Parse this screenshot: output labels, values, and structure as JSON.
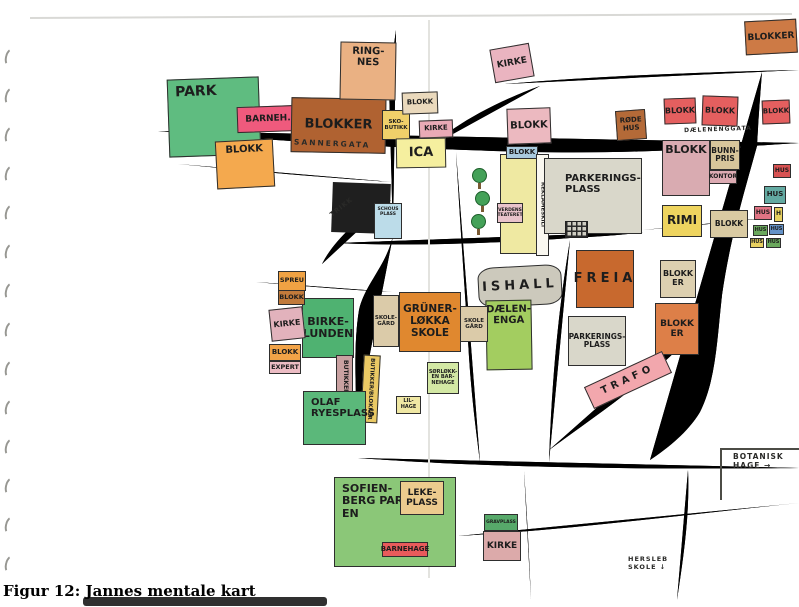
{
  "page": {
    "caption": "Figur 12: Jannes mentale kart"
  },
  "map": {
    "colors": {
      "road_fill": "#b9bdb2",
      "road_outline": "#57564e",
      "park_green": "#5fbc80",
      "crayon_orange": "#e0882f",
      "crayon_red": "#e45f5f",
      "paper": "#ffffff"
    },
    "street_labels": [
      {
        "id": "sannergata",
        "text": "SANNERGATA",
        "x": 294,
        "y": 139,
        "rot": 2.5,
        "fz": 7.5,
        "ls": 2
      },
      {
        "id": "dalenenggata",
        "text": "DÆLENENGGATA",
        "x": 684,
        "y": 126,
        "rot": -2,
        "fz": 6,
        "ls": 1
      },
      {
        "id": "trikk",
        "text": "TRIKK",
        "x": 328,
        "y": 203,
        "rot": -38,
        "fz": 6.5,
        "ls": 1
      },
      {
        "id": "botanisk-hage",
        "text": "BOTANISK\nHAGE →",
        "x": 733,
        "y": 452,
        "rot": 0,
        "fz": 7.5,
        "ls": 1
      },
      {
        "id": "hersleb-skole",
        "text": "HERSLEB\nSKOLE ↓",
        "x": 628,
        "y": 555,
        "rot": 0,
        "fz": 6.5,
        "ls": 1
      }
    ],
    "blocks": [
      {
        "id": "black-building",
        "label": "",
        "x": 332,
        "y": 183,
        "w": 58,
        "h": 50,
        "bg": "#1f1f1f",
        "rot": 2,
        "fz": 8,
        "cls": "noborder"
      },
      {
        "id": "schous-plass",
        "label": "SCHOUS PLASS",
        "x": 374,
        "y": 203,
        "w": 28,
        "h": 36,
        "bg": "#bcdce9",
        "fz": 4.5,
        "cls": "tt"
      },
      {
        "id": "park",
        "label": "PARK",
        "x": 168,
        "y": 78,
        "w": 92,
        "h": 78,
        "bg": "#5fbc80",
        "rot": -2,
        "fz": 14,
        "cls": "tl"
      },
      {
        "id": "barnehage-nw",
        "label": "BARNEH.",
        "x": 237,
        "y": 106,
        "w": 62,
        "h": 26,
        "bg": "#ef5a7d",
        "rot": -2,
        "fz": 9
      },
      {
        "id": "blokker-nw",
        "label": "BLOKKER",
        "x": 291,
        "y": 98,
        "w": 95,
        "h": 55,
        "bg": "#b06231",
        "rot": 1,
        "fz": 13
      },
      {
        "id": "ringnes",
        "label": "RING-\nNES",
        "x": 340,
        "y": 42,
        "w": 56,
        "h": 58,
        "bg": "#eab183",
        "rot": 1,
        "fz": 10,
        "cls": "tt"
      },
      {
        "id": "blokk-w",
        "label": "BLOKK",
        "x": 216,
        "y": 140,
        "w": 58,
        "h": 48,
        "bg": "#f4a94e",
        "rot": -3,
        "fz": 10,
        "cls": "tt"
      },
      {
        "id": "sko-butikk",
        "label": "SKO-\nBUTIKK",
        "x": 382,
        "y": 110,
        "w": 28,
        "h": 30,
        "bg": "#f0d06a",
        "fz": 5.5
      },
      {
        "id": "blokk-tan-n",
        "label": "BLOKK",
        "x": 402,
        "y": 92,
        "w": 36,
        "h": 22,
        "bg": "#ead9bc",
        "rot": -2,
        "fz": 7
      },
      {
        "id": "kirke-n1",
        "label": "KIRKE",
        "x": 419,
        "y": 120,
        "w": 34,
        "h": 18,
        "bg": "#e9aab6",
        "rot": -2,
        "fz": 7
      },
      {
        "id": "ica",
        "label": "ICA",
        "x": 396,
        "y": 138,
        "w": 50,
        "h": 30,
        "bg": "#f5ef9f",
        "rot": -1,
        "fz": 13
      },
      {
        "id": "kirke-n2",
        "label": "KIRKE",
        "x": 492,
        "y": 46,
        "w": 40,
        "h": 34,
        "bg": "#eab4c0",
        "rot": -10,
        "fz": 9
      },
      {
        "id": "blokk-pink-n",
        "label": "BLOKK",
        "x": 507,
        "y": 108,
        "w": 44,
        "h": 36,
        "bg": "#ecb9c0",
        "rot": -2,
        "fz": 10
      },
      {
        "id": "reklame-building",
        "label": "",
        "x": 500,
        "y": 154,
        "w": 40,
        "h": 100,
        "bg": "#efe9a2",
        "fz": 6
      },
      {
        "id": "blokk-blue-header",
        "label": "BLOKK",
        "x": 506,
        "y": 146,
        "w": 32,
        "h": 13,
        "bg": "#a9cade",
        "fz": 7
      },
      {
        "id": "reklameskilt",
        "label": "REKLAMESKILT",
        "x": 536,
        "y": 154,
        "w": 13,
        "h": 102,
        "bg": "#faf8f0",
        "fz": 5.5,
        "cls": "vert"
      },
      {
        "id": "verdens-teateret",
        "label": "VERDENS\nTEATERET",
        "x": 497,
        "y": 203,
        "w": 26,
        "h": 20,
        "bg": "#e9c3cb",
        "fz": 4.5
      },
      {
        "id": "parkeringsplass-n",
        "label": "PARKERINGS-\nPLASS",
        "x": 544,
        "y": 158,
        "w": 98,
        "h": 76,
        "bg": "#d9d7ca",
        "fz": 10,
        "cls": "pp"
      },
      {
        "id": "rode-hus",
        "label": "RØDE\nHUS",
        "x": 616,
        "y": 110,
        "w": 30,
        "h": 30,
        "bg": "#b46a38",
        "rot": -4,
        "fz": 7
      },
      {
        "id": "blokker-ne",
        "label": "BLOKKER",
        "x": 745,
        "y": 20,
        "w": 52,
        "h": 34,
        "bg": "#cd7a45",
        "rot": -3,
        "fz": 9
      },
      {
        "id": "blokk-r1",
        "label": "BLOKK",
        "x": 664,
        "y": 98,
        "w": 32,
        "h": 26,
        "bg": "#e45f5f",
        "rot": -2,
        "fz": 8
      },
      {
        "id": "blokk-r2",
        "label": "BLOKK",
        "x": 702,
        "y": 96,
        "w": 36,
        "h": 30,
        "bg": "#e45f5f",
        "rot": 2,
        "fz": 8
      },
      {
        "id": "blokk-r3",
        "label": "BLOKK",
        "x": 762,
        "y": 100,
        "w": 28,
        "h": 24,
        "bg": "#e45f5f",
        "rot": -2,
        "fz": 7
      },
      {
        "id": "blokk-big-e",
        "label": "BLOKK",
        "x": 662,
        "y": 140,
        "w": 48,
        "h": 56,
        "bg": "#d9abb1",
        "fz": 11,
        "cls": "tt"
      },
      {
        "id": "bunnpris",
        "label": "BUNN-\nPRIS",
        "x": 710,
        "y": 140,
        "w": 30,
        "h": 30,
        "bg": "#d7c59b",
        "fz": 7.5
      },
      {
        "id": "kontor",
        "label": "KONTOR",
        "x": 709,
        "y": 170,
        "w": 28,
        "h": 14,
        "bg": "#dcaab2",
        "fz": 6
      },
      {
        "id": "rimi",
        "label": "RIMI",
        "x": 662,
        "y": 205,
        "w": 40,
        "h": 32,
        "bg": "#eed45f",
        "fz": 12
      },
      {
        "id": "blokk-l-shape",
        "label": "BLOKK",
        "x": 710,
        "y": 210,
        "w": 38,
        "h": 28,
        "bg": "#d9caa2",
        "fz": 7.5
      },
      {
        "id": "hus-1",
        "label": "HUS",
        "x": 773,
        "y": 164,
        "w": 18,
        "h": 14,
        "bg": "#d85252",
        "fz": 6
      },
      {
        "id": "hus-2",
        "label": "HUS",
        "x": 764,
        "y": 186,
        "w": 22,
        "h": 18,
        "bg": "#63aaa2",
        "fz": 7
      },
      {
        "id": "hus-3",
        "label": "HUS",
        "x": 754,
        "y": 206,
        "w": 18,
        "h": 14,
        "bg": "#e07484",
        "fz": 6
      },
      {
        "id": "hus-4",
        "label": "H",
        "x": 774,
        "y": 207,
        "w": 9,
        "h": 15,
        "bg": "#e8d060",
        "fz": 6
      },
      {
        "id": "hus-5",
        "label": "HUS",
        "x": 753,
        "y": 225,
        "w": 15,
        "h": 11,
        "bg": "#6aa85c",
        "fz": 5
      },
      {
        "id": "hus-6",
        "label": "HUS",
        "x": 769,
        "y": 224,
        "w": 15,
        "h": 11,
        "bg": "#6492c8",
        "fz": 5
      },
      {
        "id": "hus-7",
        "label": "HUS",
        "x": 750,
        "y": 238,
        "w": 14,
        "h": 10,
        "bg": "#e8d060",
        "fz": 5
      },
      {
        "id": "hus-8",
        "label": "HUS",
        "x": 766,
        "y": 238,
        "w": 15,
        "h": 10,
        "bg": "#6aa85c",
        "fz": 5
      },
      {
        "id": "ishall",
        "label": "ISHALL",
        "x": 478,
        "y": 266,
        "w": 84,
        "h": 40,
        "bg": "#ccc9bc",
        "rot": -3,
        "fz": 13,
        "cls": "rounded spread"
      },
      {
        "id": "freia",
        "label": "FREIA",
        "x": 576,
        "y": 250,
        "w": 58,
        "h": 58,
        "bg": "#c8692e",
        "fz": 13,
        "cls": "spread"
      },
      {
        "id": "blokker-tan-e",
        "label": "BLOKK\nER",
        "x": 660,
        "y": 260,
        "w": 36,
        "h": 38,
        "bg": "#ddd0b0",
        "fz": 8
      },
      {
        "id": "blokker-orange-e",
        "label": "BLOKK\nER",
        "x": 655,
        "y": 303,
        "w": 44,
        "h": 52,
        "bg": "#dd7f48",
        "fz": 9
      },
      {
        "id": "parkeringsplass-s",
        "label": "PARKERINGS-\nPLASS",
        "x": 568,
        "y": 316,
        "w": 58,
        "h": 50,
        "bg": "#d9d7ca",
        "fz": 7.5
      },
      {
        "id": "dalenenga",
        "label": "DÆLEN-\nENGA",
        "x": 486,
        "y": 300,
        "w": 46,
        "h": 70,
        "bg": "#a3cd60",
        "rot": -1,
        "fz": 10,
        "cls": "tt"
      },
      {
        "id": "skolegard-e",
        "label": "SKOLE\nGÅRD",
        "x": 460,
        "y": 306,
        "w": 28,
        "h": 36,
        "bg": "#dbcba9",
        "fz": 5.5
      },
      {
        "id": "grunerlokka-skole",
        "label": "GRÜNER-\nLØKKA\nSKOLE",
        "x": 399,
        "y": 292,
        "w": 62,
        "h": 60,
        "bg": "#e0882f",
        "fz": 10.5
      },
      {
        "id": "skolegard-w",
        "label": "SKOLE-\nGÅRD",
        "x": 373,
        "y": 295,
        "w": 26,
        "h": 52,
        "bg": "#dbcba9",
        "fz": 5.5
      },
      {
        "id": "birkelunden",
        "label": "BIRKE-\nLUNDEN",
        "x": 302,
        "y": 298,
        "w": 52,
        "h": 60,
        "bg": "#4fb271",
        "fz": 11
      },
      {
        "id": "spreu",
        "label": "SPREU",
        "x": 278,
        "y": 271,
        "w": 28,
        "h": 20,
        "bg": "#f0a243",
        "fz": 6.5
      },
      {
        "id": "blokk-brown-w",
        "label": "BLOKK",
        "x": 278,
        "y": 290,
        "w": 27,
        "h": 15,
        "bg": "#c17a3b",
        "fz": 6.5
      },
      {
        "id": "kirke-w",
        "label": "KIRKE",
        "x": 270,
        "y": 308,
        "w": 34,
        "h": 32,
        "bg": "#e2b2bc",
        "rot": -6,
        "fz": 8
      },
      {
        "id": "blokk-orange-w",
        "label": "BLOKK",
        "x": 269,
        "y": 344,
        "w": 32,
        "h": 17,
        "bg": "#f2a347",
        "fz": 7
      },
      {
        "id": "expert",
        "label": "EXPERT",
        "x": 269,
        "y": 361,
        "w": 32,
        "h": 13,
        "bg": "#ecbcc4",
        "fz": 6.5
      },
      {
        "id": "butikker-strip",
        "label": "BUTIKKER",
        "x": 336,
        "y": 355,
        "w": 17,
        "h": 44,
        "bg": "#c9a1a1",
        "fz": 6,
        "cls": "vert"
      },
      {
        "id": "butikker-blokker-strip",
        "label": "BUTIKKER/BLOKKER",
        "x": 362,
        "y": 355,
        "w": 17,
        "h": 68,
        "bg": "#eac964",
        "rot": 3,
        "fz": 5.5,
        "cls": "vert"
      },
      {
        "id": "olaf-ryes-plass",
        "label": "OLAF\nRYESPLASS",
        "x": 303,
        "y": 391,
        "w": 63,
        "h": 54,
        "bg": "#5bb87a",
        "fz": 10,
        "cls": "tl"
      },
      {
        "id": "sorlokken-barnehage",
        "label": "SØRLØKK-\nEN BAR-\nNEHAGE",
        "x": 427,
        "y": 362,
        "w": 32,
        "h": 32,
        "bg": "#d3e8a4",
        "fz": 5
      },
      {
        "id": "lil-hage",
        "label": "LIL-\nHAGE",
        "x": 396,
        "y": 396,
        "w": 25,
        "h": 18,
        "bg": "#f0e8a4",
        "fz": 5
      },
      {
        "id": "trafo",
        "label": "TRAFO",
        "x": 585,
        "y": 368,
        "w": 86,
        "h": 24,
        "bg": "#f2a7ad",
        "rot": -25,
        "fz": 10,
        "cls": "spread"
      },
      {
        "id": "sofienbergparken",
        "label": "SOFIEN-\nBERG PARK-\nEN",
        "x": 334,
        "y": 477,
        "w": 122,
        "h": 90,
        "bg": "#8bc778",
        "fz": 11,
        "cls": "tl"
      },
      {
        "id": "lekeplass",
        "label": "LEKE-\nPLASS",
        "x": 400,
        "y": 481,
        "w": 44,
        "h": 34,
        "bg": "#eccb8e",
        "fz": 9
      },
      {
        "id": "barnehage-s",
        "label": "BARNEHAGE",
        "x": 382,
        "y": 542,
        "w": 46,
        "h": 15,
        "bg": "#e85b5b",
        "fz": 7
      },
      {
        "id": "gravplass",
        "label": "GRAVPLASS",
        "x": 484,
        "y": 514,
        "w": 34,
        "h": 17,
        "bg": "#57a96a",
        "fz": 4.5
      },
      {
        "id": "kirke-s",
        "label": "KIRKE",
        "x": 483,
        "y": 531,
        "w": 38,
        "h": 30,
        "bg": "#dcaaaa",
        "fz": 9
      }
    ],
    "trees": [
      {
        "x": 472,
        "y": 168
      },
      {
        "x": 475,
        "y": 191
      },
      {
        "x": 471,
        "y": 214
      }
    ]
  }
}
